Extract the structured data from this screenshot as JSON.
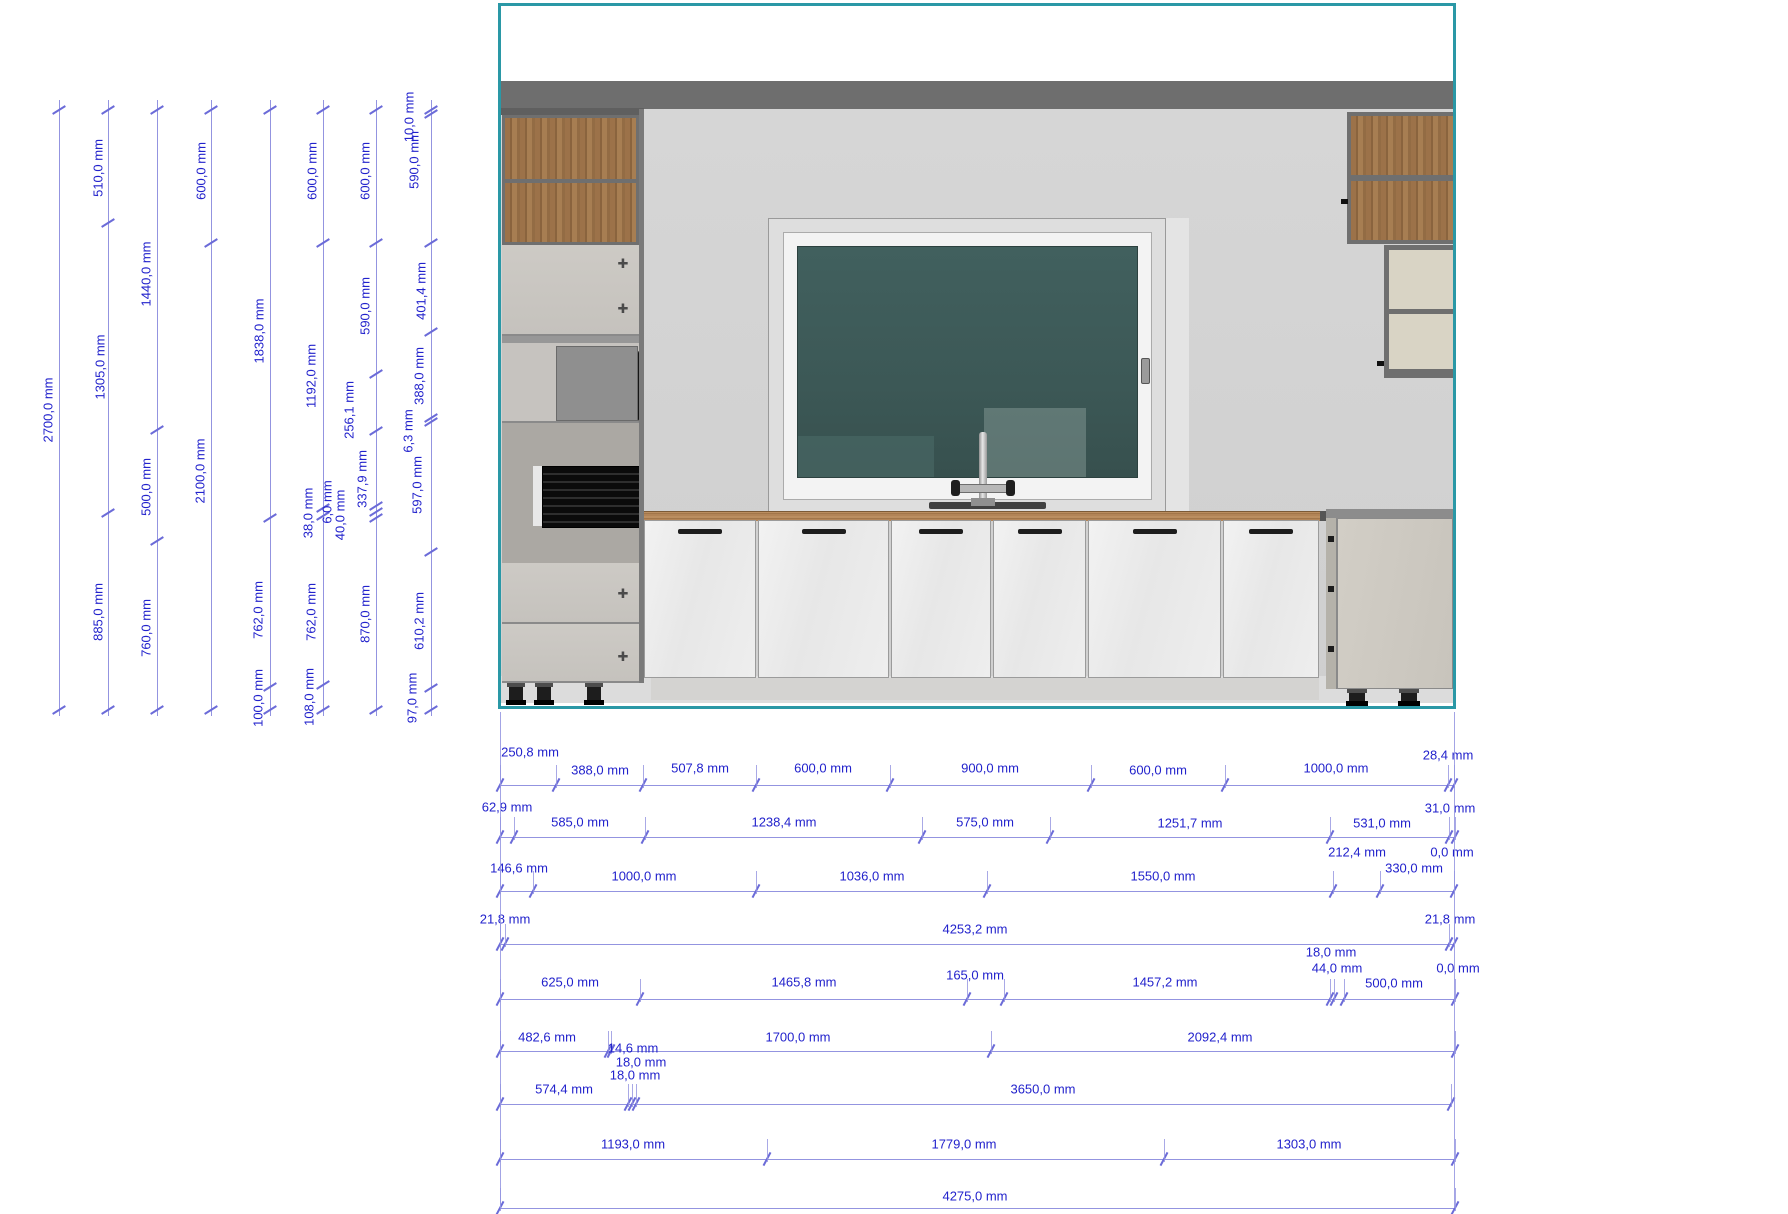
{
  "title": "Kitchen elevation drawing with dimensions",
  "unit": "mm",
  "colors": {
    "dimension_text": "#2222cc",
    "dimension_line": "#9394e0",
    "tick": "#6b6bd8",
    "viewport_border_teal": "#2a98a6",
    "wall": "#d2d2d2",
    "soffit": "#6e6e6e",
    "cabinet_carcass": "#6f6f6f",
    "wood_front": "#9c7249",
    "countertop_wood": "#b28457",
    "window_glass": "#3e5a58",
    "base_door": "#ebebeb",
    "tall_door": "#cac7c2",
    "cream_shelf": "#d9d4c5",
    "right_base_door": "#cdc9c1",
    "handle": "#1d1d1d"
  },
  "scene_parts": [
    "ceiling-strip",
    "soffit",
    "wall",
    "floor-strip",
    "left-wood-wall-cabinet",
    "tall-cabinet-doors",
    "microwave-unit",
    "oven-unit",
    "tall-cabinet-drawers",
    "adjustable-feet",
    "countertop",
    "base-cabinet-doors",
    "window",
    "window-glass",
    "window-handle",
    "faucet",
    "sink",
    "right-wood-wall-cabinet",
    "right-open-shelf-unit",
    "right-base-cabinet"
  ],
  "vertical_dimensions": [
    {
      "x": 59,
      "ticks": [
        110,
        710
      ],
      "labels": [
        {
          "text": "2700,0 mm",
          "x": 48,
          "y": 410
        }
      ]
    },
    {
      "x": 108,
      "ticks": [
        110,
        223,
        513,
        710
      ],
      "labels": [
        {
          "text": "510,0 mm",
          "x": 98,
          "y": 168
        },
        {
          "text": "1305,0 mm",
          "x": 100,
          "y": 367
        },
        {
          "text": "885,0 mm",
          "x": 98,
          "y": 612
        }
      ]
    },
    {
      "x": 157,
      "ticks": [
        110,
        430,
        541,
        710
      ],
      "labels": [
        {
          "text": "1440,0 mm",
          "x": 146,
          "y": 274
        },
        {
          "text": "500,0 mm",
          "x": 146,
          "y": 487
        },
        {
          "text": "760,0 mm",
          "x": 146,
          "y": 628
        }
      ]
    },
    {
      "x": 211,
      "ticks": [
        110,
        243,
        710
      ],
      "labels": [
        {
          "text": "600,0 mm",
          "x": 201,
          "y": 171
        },
        {
          "text": "2100,0 mm",
          "x": 200,
          "y": 471
        }
      ]
    },
    {
      "x": 270,
      "ticks": [
        110,
        518,
        687,
        710
      ],
      "labels": [
        {
          "text": "1838,0 mm",
          "x": 259,
          "y": 331
        },
        {
          "text": "762,0 mm",
          "x": 258,
          "y": 610
        },
        {
          "text": "100,0 mm",
          "x": 258,
          "y": 698
        }
      ]
    },
    {
      "x": 323,
      "ticks": [
        110,
        243,
        508,
        516,
        685,
        710
      ],
      "labels": [
        {
          "text": "600,0 mm",
          "x": 312,
          "y": 171
        },
        {
          "text": "1192,0 mm",
          "x": 311,
          "y": 376
        },
        {
          "text": "38,0 mm",
          "x": 308,
          "y": 513
        },
        {
          "text": "762,0 mm",
          "x": 311,
          "y": 612
        },
        {
          "text": "108,0 mm",
          "x": 309,
          "y": 697
        }
      ]
    },
    {
      "x": 376,
      "ticks": [
        110,
        243,
        374,
        431,
        506,
        512,
        518,
        710
      ],
      "labels": [
        {
          "text": "600,0 mm",
          "x": 365,
          "y": 171
        },
        {
          "text": "590,0 mm",
          "x": 365,
          "y": 306
        },
        {
          "text": "256,1 mm",
          "x": 349,
          "y": 410
        },
        {
          "text": "337,9 mm",
          "x": 362,
          "y": 479
        },
        {
          "text": "6,0 mm",
          "x": 327,
          "y": 502
        },
        {
          "text": "40,0 mm",
          "x": 340,
          "y": 515
        },
        {
          "text": "870,0 mm",
          "x": 365,
          "y": 614
        }
      ]
    },
    {
      "x": 431,
      "ticks": [
        110,
        114,
        243,
        332,
        418,
        422,
        552,
        688,
        710
      ],
      "labels": [
        {
          "text": "10,0 mm",
          "x": 409,
          "y": 117
        },
        {
          "text": "590,0 mm",
          "x": 414,
          "y": 160
        },
        {
          "text": "401,4 mm",
          "x": 421,
          "y": 291
        },
        {
          "text": "388,0 mm",
          "x": 419,
          "y": 376
        },
        {
          "text": "6,3 mm",
          "x": 408,
          "y": 431
        },
        {
          "text": "597,0 mm",
          "x": 417,
          "y": 485
        },
        {
          "text": "610,2 mm",
          "x": 419,
          "y": 621
        },
        {
          "text": "97,0 mm",
          "x": 412,
          "y": 698
        }
      ]
    }
  ],
  "horizontal_dimensions": [
    {
      "y": 785,
      "x1": 500,
      "x2": 1454,
      "ticks": [
        500,
        556,
        643,
        756,
        890,
        1091,
        1225,
        1448,
        1454
      ],
      "labels": [
        {
          "text": "250,8 mm",
          "x": 530,
          "y": 752
        },
        {
          "text": "388,0 mm",
          "x": 600,
          "y": 770
        },
        {
          "text": "507,8 mm",
          "x": 700,
          "y": 768
        },
        {
          "text": "600,0 mm",
          "x": 823,
          "y": 768
        },
        {
          "text": "900,0 mm",
          "x": 990,
          "y": 768
        },
        {
          "text": "600,0 mm",
          "x": 1158,
          "y": 770
        },
        {
          "text": "1000,0 mm",
          "x": 1336,
          "y": 768
        },
        {
          "text": "28,4 mm",
          "x": 1448,
          "y": 755
        }
      ]
    },
    {
      "y": 837,
      "x1": 500,
      "x2": 1455,
      "ticks": [
        500,
        514,
        645,
        922,
        1050,
        1330,
        1449,
        1455
      ],
      "labels": [
        {
          "text": "62,9 mm",
          "x": 507,
          "y": 807
        },
        {
          "text": "585,0 mm",
          "x": 580,
          "y": 822
        },
        {
          "text": "1238,4 mm",
          "x": 784,
          "y": 822
        },
        {
          "text": "575,0 mm",
          "x": 985,
          "y": 822
        },
        {
          "text": "1251,7 mm",
          "x": 1190,
          "y": 823
        },
        {
          "text": "531,0 mm",
          "x": 1382,
          "y": 823
        },
        {
          "text": "31,0 mm",
          "x": 1450,
          "y": 808
        }
      ]
    },
    {
      "y": 891,
      "x1": 500,
      "x2": 1454,
      "ticks": [
        500,
        533,
        756,
        987,
        1333,
        1380,
        1454
      ],
      "labels": [
        {
          "text": "146,6 mm",
          "x": 519,
          "y": 868
        },
        {
          "text": "1000,0 mm",
          "x": 644,
          "y": 876
        },
        {
          "text": "1036,0 mm",
          "x": 872,
          "y": 876
        },
        {
          "text": "1550,0 mm",
          "x": 1163,
          "y": 876
        },
        {
          "text": "212,4 mm",
          "x": 1357,
          "y": 852
        },
        {
          "text": "330,0 mm",
          "x": 1414,
          "y": 868
        },
        {
          "text": "0,0 mm",
          "x": 1452,
          "y": 852
        }
      ]
    },
    {
      "y": 944,
      "x1": 500,
      "x2": 1454,
      "ticks": [
        500,
        505,
        1449,
        1454
      ],
      "labels": [
        {
          "text": "21,8 mm",
          "x": 505,
          "y": 919
        },
        {
          "text": "4253,2 mm",
          "x": 975,
          "y": 929
        },
        {
          "text": "21,8 mm",
          "x": 1450,
          "y": 919
        }
      ]
    },
    {
      "y": 999,
      "x1": 500,
      "x2": 1455,
      "ticks": [
        500,
        640,
        967,
        1004,
        1330,
        1334,
        1344,
        1455
      ],
      "labels": [
        {
          "text": "625,0 mm",
          "x": 570,
          "y": 982
        },
        {
          "text": "1465,8 mm",
          "x": 804,
          "y": 982
        },
        {
          "text": "165,0 mm",
          "x": 975,
          "y": 975
        },
        {
          "text": "1457,2 mm",
          "x": 1165,
          "y": 982
        },
        {
          "text": "18,0 mm",
          "x": 1331,
          "y": 952
        },
        {
          "text": "44,0 mm",
          "x": 1337,
          "y": 968
        },
        {
          "text": "500,0 mm",
          "x": 1394,
          "y": 983
        },
        {
          "text": "0,0 mm",
          "x": 1458,
          "y": 968
        }
      ]
    },
    {
      "y": 1051,
      "x1": 500,
      "x2": 1455,
      "ticks": [
        500,
        608,
        611,
        991,
        1455
      ],
      "labels": [
        {
          "text": "482,6 mm",
          "x": 547,
          "y": 1037
        },
        {
          "text": "14,6 mm",
          "x": 633,
          "y": 1048
        },
        {
          "text": "1700,0 mm",
          "x": 798,
          "y": 1037
        },
        {
          "text": "2092,4 mm",
          "x": 1220,
          "y": 1037
        },
        {
          "text": "18,0 mm",
          "x": 641,
          "y": 1062
        },
        {
          "text": "18,0 mm",
          "x": 635,
          "y": 1075
        }
      ]
    },
    {
      "y": 1104,
      "x1": 500,
      "x2": 1451,
      "ticks": [
        500,
        628,
        632,
        636,
        1451
      ],
      "labels": [
        {
          "text": "574,4 mm",
          "x": 564,
          "y": 1089
        },
        {
          "text": "3650,0 mm",
          "x": 1043,
          "y": 1089
        }
      ]
    },
    {
      "y": 1159,
      "x1": 500,
      "x2": 1455,
      "ticks": [
        500,
        767,
        1164,
        1455
      ],
      "labels": [
        {
          "text": "1193,0 mm",
          "x": 633,
          "y": 1144
        },
        {
          "text": "1779,0 mm",
          "x": 964,
          "y": 1144
        },
        {
          "text": "1303,0 mm",
          "x": 1309,
          "y": 1144
        }
      ]
    },
    {
      "y": 1208,
      "x1": 500,
      "x2": 1455,
      "ticks": [
        500,
        1455
      ],
      "labels": [
        {
          "text": "4275,0 mm",
          "x": 975,
          "y": 1196
        }
      ]
    }
  ],
  "extension_lines": [
    {
      "x": 500,
      "y1": 712,
      "y2": 1208
    },
    {
      "x": 1454,
      "y1": 712,
      "y2": 1208
    }
  ]
}
